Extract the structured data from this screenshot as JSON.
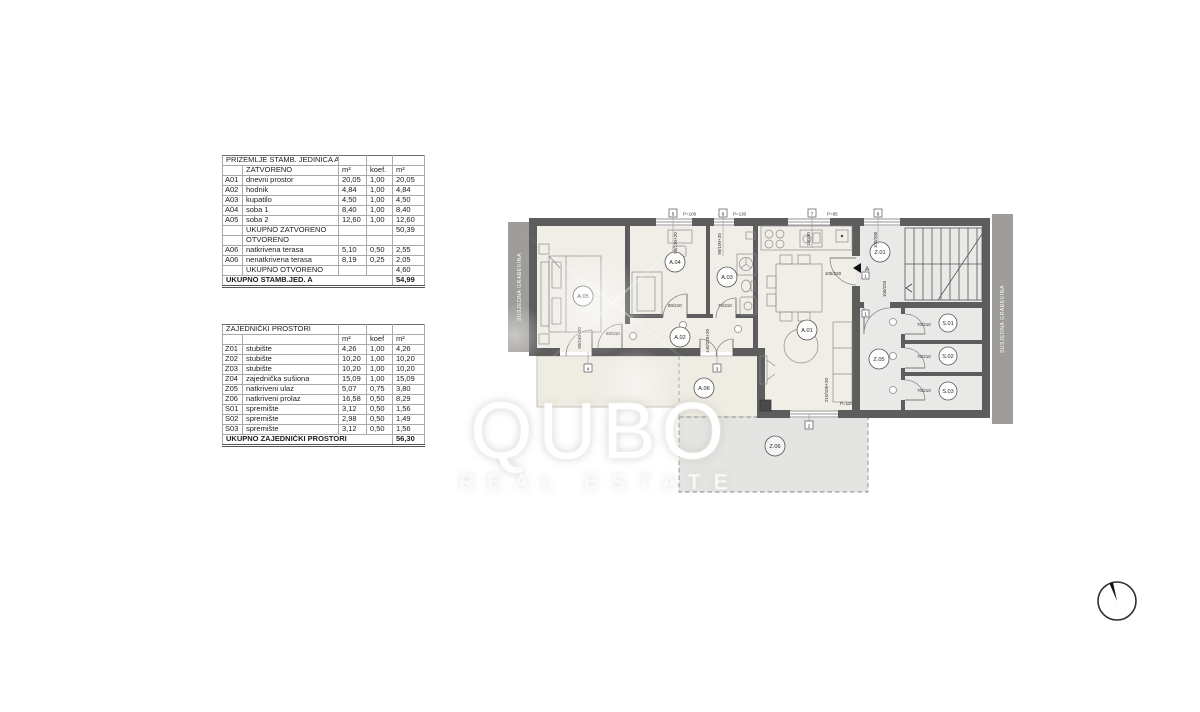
{
  "watermark": {
    "brand": "QUBO",
    "sub": "REAL ESTATE"
  },
  "tables": [
    {
      "name": "unit-a-areas",
      "rows": [
        {
          "t": "title",
          "name": "PRIZEMLJE STAMB. JEDINICA A"
        },
        {
          "t": "units",
          "name": "ZATVORENO",
          "m2": "m²",
          "koef": "koef.",
          "tot": "m²"
        },
        {
          "t": "row",
          "id": "A01",
          "name": "dnevni prostor",
          "m2": "20,05",
          "koef": "1,00",
          "tot": "20,05"
        },
        {
          "t": "row",
          "id": "A02",
          "name": "hodnik",
          "m2": "4,84",
          "koef": "1,00",
          "tot": "4,84"
        },
        {
          "t": "row",
          "id": "A03",
          "name": "kupatilo",
          "m2": "4,50",
          "koef": "1,00",
          "tot": "4,50"
        },
        {
          "t": "row",
          "id": "A04",
          "name": "soba 1",
          "m2": "8,40",
          "koef": "1,00",
          "tot": "8,40"
        },
        {
          "t": "row",
          "id": "A05",
          "name": "soba 2",
          "m2": "12,60",
          "koef": "1,00",
          "tot": "12,60"
        },
        {
          "t": "subtotal",
          "name": "UKUPNO ZATVORENO",
          "tot": "50,39"
        },
        {
          "t": "section",
          "name": "OTVORENO"
        },
        {
          "t": "row",
          "id": "A06",
          "name": "natkrivena terasa",
          "m2": "5,10",
          "koef": "0,50",
          "tot": "2,55"
        },
        {
          "t": "row",
          "id": "A06",
          "name": "nenatkrivena terasa",
          "m2": "8,19",
          "koef": "0,25",
          "tot": "2,05"
        },
        {
          "t": "subtotal",
          "name": "UKUPNO OTVORENO",
          "tot": "4,60"
        },
        {
          "t": "grand",
          "name": "UKUPNO STAMB.JED. A",
          "tot": "54,99"
        }
      ]
    },
    {
      "name": "common-areas",
      "rows": [
        {
          "t": "title",
          "name": "ZAJEDNIČKI PROSTORI"
        },
        {
          "t": "units",
          "name": "",
          "m2": "m²",
          "koef": "koef",
          "tot": "m²"
        },
        {
          "t": "row",
          "id": "Z01",
          "name": "stubište",
          "m2": "4,26",
          "koef": "1,00",
          "tot": "4,26"
        },
        {
          "t": "row",
          "id": "Z02",
          "name": "stubište",
          "m2": "10,20",
          "koef": "1,00",
          "tot": "10,20"
        },
        {
          "t": "row",
          "id": "Z03",
          "name": "stubište",
          "m2": "10,20",
          "koef": "1,00",
          "tot": "10,20"
        },
        {
          "t": "row",
          "id": "Z04",
          "name": "zajednička sušiona",
          "m2": "15,09",
          "koef": "1,00",
          "tot": "15,09"
        },
        {
          "t": "row",
          "id": "Z05",
          "name": "natkriveni ulaz",
          "m2": "5,07",
          "koef": "0,75",
          "tot": "3,80"
        },
        {
          "t": "row",
          "id": "Z06",
          "name": "natkriveni prolaz",
          "m2": "16,58",
          "koef": "0,50",
          "tot": "8,29"
        },
        {
          "t": "row",
          "id": "S01",
          "name": "spremište",
          "m2": "3,12",
          "koef": "0,50",
          "tot": "1,56"
        },
        {
          "t": "row",
          "id": "S02",
          "name": "spremište",
          "m2": "2,98",
          "koef": "0,50",
          "tot": "1,49"
        },
        {
          "t": "row",
          "id": "S03",
          "name": "spremište",
          "m2": "3,12",
          "koef": "0,50",
          "tot": "1,56"
        },
        {
          "t": "grand",
          "name": "UKUPNO ZAJEDNIČKI PROSTORI",
          "tot": "56,30"
        }
      ]
    }
  ],
  "plan": {
    "neighbor_left": "SUSJEDNA GRAĐEVINA",
    "neighbor_right": "SUSJEDNA GRAĐEVINA",
    "entrance_label": "A",
    "rooms": {
      "a01": "A.01",
      "a02": "A.02",
      "a03": "A.03",
      "a04": "A.04",
      "a05": "A.05",
      "a06": "A.06",
      "z01": "Z.01",
      "z05": "Z.05",
      "z06": "Z.06",
      "s01": "S.01",
      "s02": "S.02",
      "s03": "S.03"
    },
    "markers": {
      "m1a": "1",
      "m1b": "1",
      "m2": "2",
      "m3": "3",
      "m4": "4",
      "m5": "5",
      "m6": "6",
      "m7": "7",
      "m8": "8"
    },
    "dims": {
      "p100": "P=100",
      "p130": "P=130",
      "p95": "P=95",
      "p110": "P=110",
      "win_a04": "90/130+20",
      "win_a03": "90/100+20",
      "win_stair": "100/200",
      "win_a01": "210/100+20",
      "door_entry": "105/220",
      "door_z01": "100/220",
      "door_s1": "70/210",
      "door_s2": "70/210",
      "door_s3": "70/210",
      "door_a05": "80/210",
      "door_a04": "80/210",
      "door_a03": "70/210",
      "door_a05_terrace": "90/240+20",
      "door_a02_terrace": "140/220+20",
      "kitchen_unit": "140/90"
    },
    "colors": {
      "wall": "#5d5d5d",
      "room_fill": "#f1eee8",
      "common_fill": "#e9e9e7",
      "terrace_fill": "#efece3",
      "passage_fill": "#e4e4e2",
      "neighbor_strip": "#9f9d9a"
    }
  }
}
